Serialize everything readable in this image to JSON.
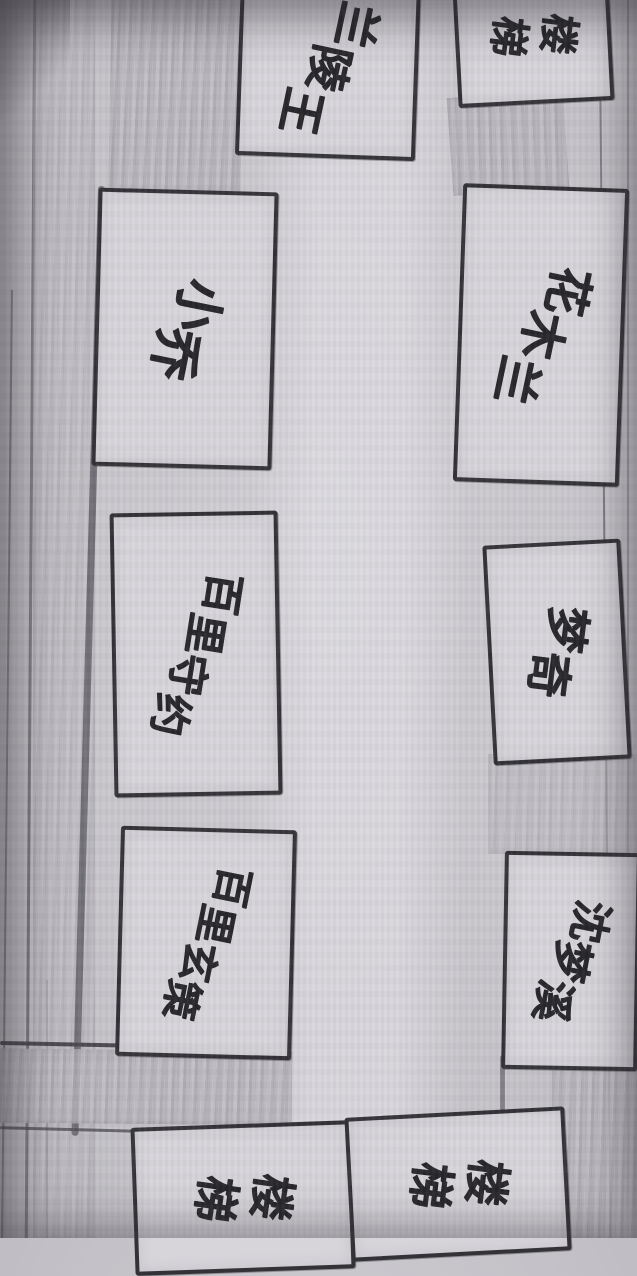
{
  "map": {
    "description": "Hand-drawn corridor map in black marker on gray ruled paper; rooms labeled with rotated Chinese handwriting, corridor running vertically between them",
    "rooms": [
      {
        "id": "lanlingwang",
        "label": "兰陵王"
      },
      {
        "id": "stairs-top",
        "label": "楼梯"
      },
      {
        "id": "xiaoqiao",
        "label": "小乔"
      },
      {
        "id": "huamulan",
        "label": "花木兰"
      },
      {
        "id": "bailishouyue",
        "label": "百里守约"
      },
      {
        "id": "mengqi",
        "label": "梦奇"
      },
      {
        "id": "bailixuance",
        "label": "百里玄策"
      },
      {
        "id": "shenmengxi",
        "label": "沈梦溪"
      },
      {
        "id": "stairs-bottom-left",
        "label": "楼梯"
      },
      {
        "id": "stairs-bottom-right",
        "label": "楼梯"
      }
    ],
    "colors": {
      "paper": "#c9c7cc",
      "road": "#dcdade",
      "ink": "#2c2b2f",
      "pencil_line": "#7c7a80",
      "wall_shading": "#b6b4ba"
    }
  }
}
